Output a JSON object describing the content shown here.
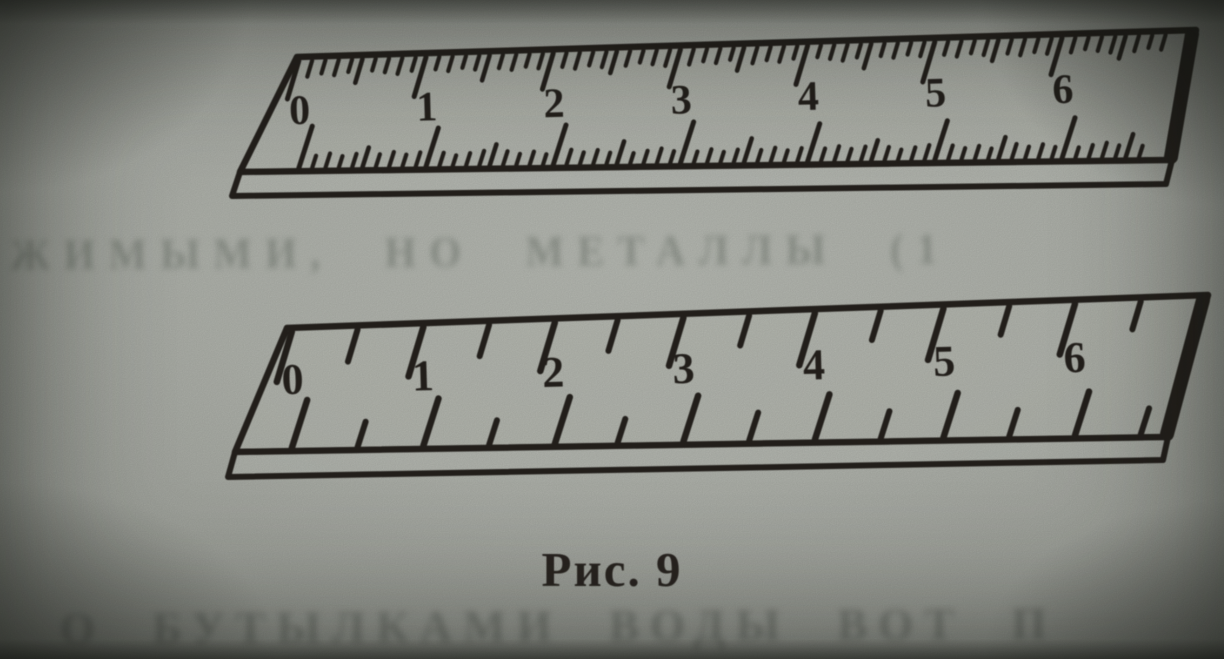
{
  "figure": {
    "caption": "Рис. 9"
  },
  "rulers": [
    {
      "id": "top-ruler",
      "unit_labels": [
        "0",
        "1",
        "2",
        "3",
        "4",
        "5",
        "6"
      ],
      "divisions_per_unit": 10,
      "style": "fine millimeter divisions"
    },
    {
      "id": "bottom-ruler",
      "unit_labels": [
        "0",
        "1",
        "2",
        "3",
        "4",
        "5",
        "6"
      ],
      "divisions_per_unit": 2,
      "style": "coarse half-centimeter divisions"
    }
  ],
  "bleed_through_approx": {
    "middle_line": "ОЖИМЫМИ,  НО  МЕТАЛЛЫ  (1",
    "bottom_line": "О  БУТЫЛКАМИ  ВОДЫ  ВОТ  П"
  },
  "colors": {
    "ink": "#25211d",
    "paper": "#aeb1aa"
  }
}
